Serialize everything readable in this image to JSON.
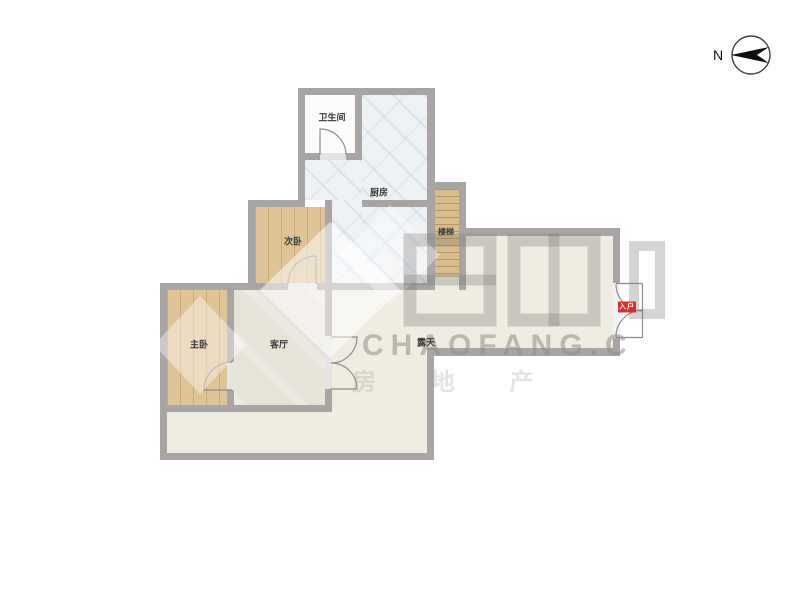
{
  "compass": {
    "label": "N"
  },
  "rooms": [
    {
      "name": "bathroom",
      "label": "卫生间"
    },
    {
      "name": "kitchen",
      "label": "厨房"
    },
    {
      "name": "second-bedroom",
      "label": "次卧"
    },
    {
      "name": "stairs",
      "label": "楼梯"
    },
    {
      "name": "master-bedroom",
      "label": "主卧"
    },
    {
      "name": "living-room",
      "label": "客厅"
    },
    {
      "name": "terrace",
      "label": "露天"
    }
  ],
  "entrance": {
    "label": "入户",
    "color": "#d9302c"
  },
  "watermark": {
    "latin": "CHAOFANG.C",
    "cjk": "房 地 产"
  },
  "colors": {
    "wall": "#a9a5a5",
    "wood_floor": "#dfc498",
    "kitchen_tile": "#eef2f5",
    "terrace_beige": "#efece1",
    "living_floor": "#e8e3d8",
    "bathroom_floor": "#fcfcfc",
    "entrance_red": "#d9302c"
  }
}
